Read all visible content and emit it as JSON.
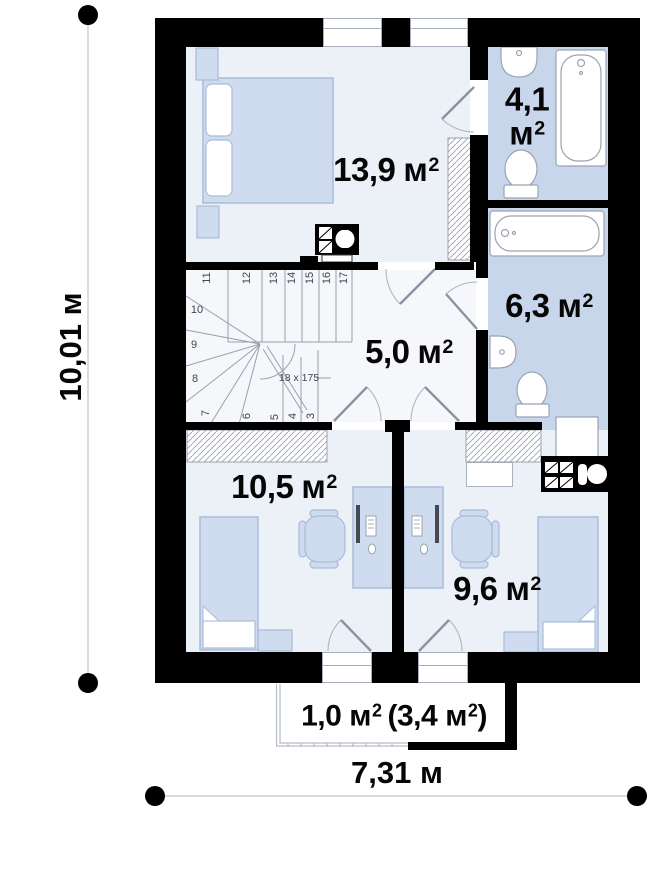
{
  "plan": {
    "dimensions": {
      "width": "7,31 м",
      "height": "10,01 м"
    },
    "rooms": {
      "bedroom": {
        "value": "13,9",
        "unit": "м",
        "sup": "2"
      },
      "bath_top": {
        "value": "4,1",
        "unit": "м",
        "sup": "2"
      },
      "bath_mid": {
        "value": "6,3",
        "unit": "м",
        "sup": "2"
      },
      "hall": {
        "value": "5,0",
        "unit": "м",
        "sup": "2"
      },
      "child_left": {
        "value": "10,5",
        "unit": "м",
        "sup": "2"
      },
      "child_right": {
        "value": "9,6",
        "unit": "м",
        "sup": "2"
      }
    },
    "balcony": {
      "value": "1,0",
      "unit": "м",
      "sup": "2",
      "paren_open": "(",
      "paren_value": "3,4",
      "paren_close": ")"
    },
    "stairs": {
      "steps": [
        "3",
        "4",
        "5",
        "6",
        "7",
        "8",
        "9",
        "10",
        "11",
        "12",
        "13",
        "14",
        "15",
        "16",
        "17"
      ],
      "annotation": "18 x 175"
    }
  }
}
